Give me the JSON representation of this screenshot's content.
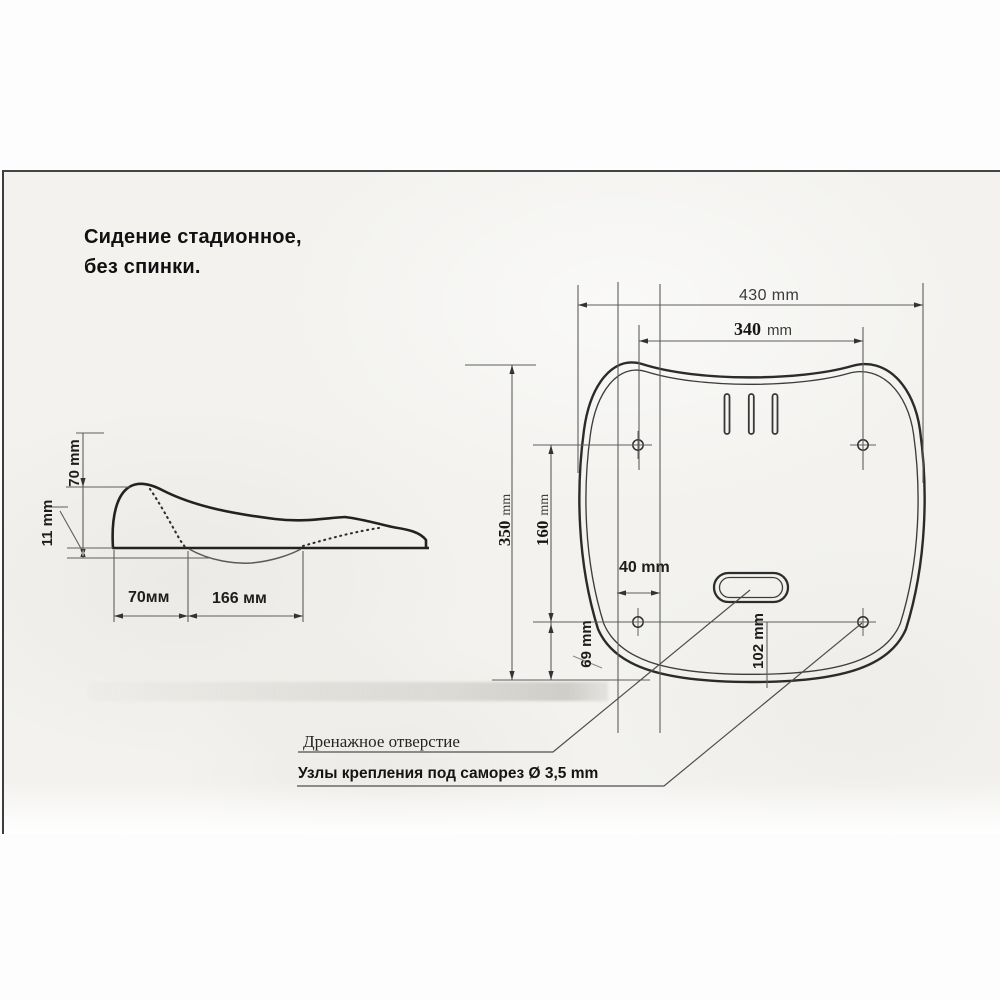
{
  "document": {
    "title_line1": "Сидение стадионное,",
    "title_line2": "без спинки."
  },
  "side_view": {
    "dim_height": "70 mm",
    "dim_lip": "11 mm",
    "dim_width_front": "70мм",
    "dim_width_mid": "166 мм"
  },
  "top_view": {
    "dim_overall_width": "430 mm",
    "dim_hole_span_value": "340",
    "dim_hole_span_unit": "mm",
    "dim_overall_depth_value": "350",
    "dim_overall_depth_unit": "mm",
    "dim_hole_depth_value": "160",
    "dim_hole_depth_unit": "mm",
    "dim_slot_offset": "40 mm",
    "dim_rear_offset": "69 mm",
    "dim_drain_offset": "102 mm"
  },
  "callouts": {
    "drain_hole": "Дренажное отверстие",
    "mount_points": "Узлы крепления под саморез Ø 3,5 mm"
  },
  "colors": {
    "paper": "#f3f2ef",
    "line_dark": "#2b2b2b",
    "line_dim": "#5f5f5f",
    "text": "#1c1c1c"
  }
}
